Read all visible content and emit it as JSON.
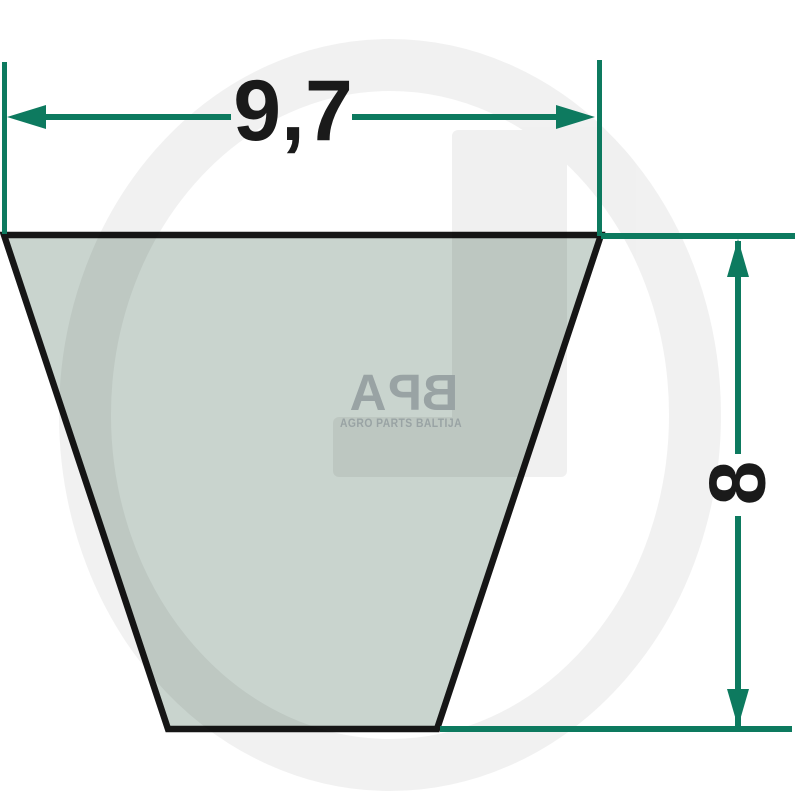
{
  "diagram": {
    "title": "V-belt cross-section dimension drawing",
    "dimensions": {
      "width_label": "9,7",
      "height_label": "8"
    }
  },
  "watermark": {
    "background_letter": "G",
    "logo": {
      "letters": [
        "A",
        "P",
        "B"
      ],
      "subtitle": "AGRO PARTS BALTIJA"
    }
  },
  "colors": {
    "dimension_green": "#0d7a5f",
    "belt_fill": "#c9d4ce",
    "belt_outline": "#161616",
    "digit_black": "#1a1a1a",
    "watermark_gray": "#f1f1f1",
    "logo_gray": "#99a3a4"
  }
}
